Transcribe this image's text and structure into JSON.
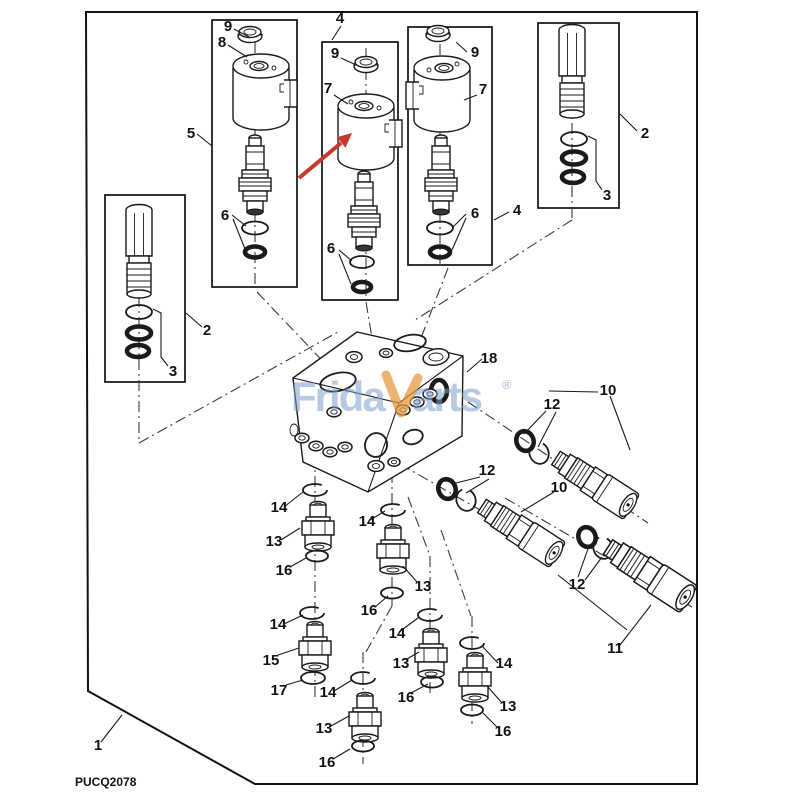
{
  "drawing": {
    "code": "PUCQ2078",
    "watermark": {
      "left": "Frida",
      "right": "arts",
      "reg": "®"
    },
    "colors": {
      "arrow_red": "#c9362c",
      "watermark_blue": "#7da0cd",
      "watermark_orange": "#e89a40"
    },
    "labels": {
      "l9a": "9",
      "l8": "8",
      "l5": "5",
      "l6a": "6",
      "l4a": "4",
      "l9b": "9",
      "l7a": "7",
      "l6b": "6",
      "l9c": "9",
      "l7b": "7",
      "l6c": "6",
      "l4b": "4",
      "l2a": "2",
      "l3a": "3",
      "l2b": "2",
      "l3b": "3",
      "l18": "18",
      "l10a": "10",
      "l12a": "12",
      "l12b": "12",
      "l10b": "10",
      "l12c": "12",
      "l11": "11",
      "l14a": "14",
      "l14b": "14",
      "l14c": "14",
      "l14d": "14",
      "l14e": "14",
      "l14f": "14",
      "l13a": "13",
      "l13b": "13",
      "l13c": "13",
      "l13d": "13",
      "l13e": "13",
      "l16a": "16",
      "l16b": "16",
      "l16c": "16",
      "l16d": "16",
      "l16e": "16",
      "l15": "15",
      "l17": "17",
      "l1": "1"
    }
  }
}
